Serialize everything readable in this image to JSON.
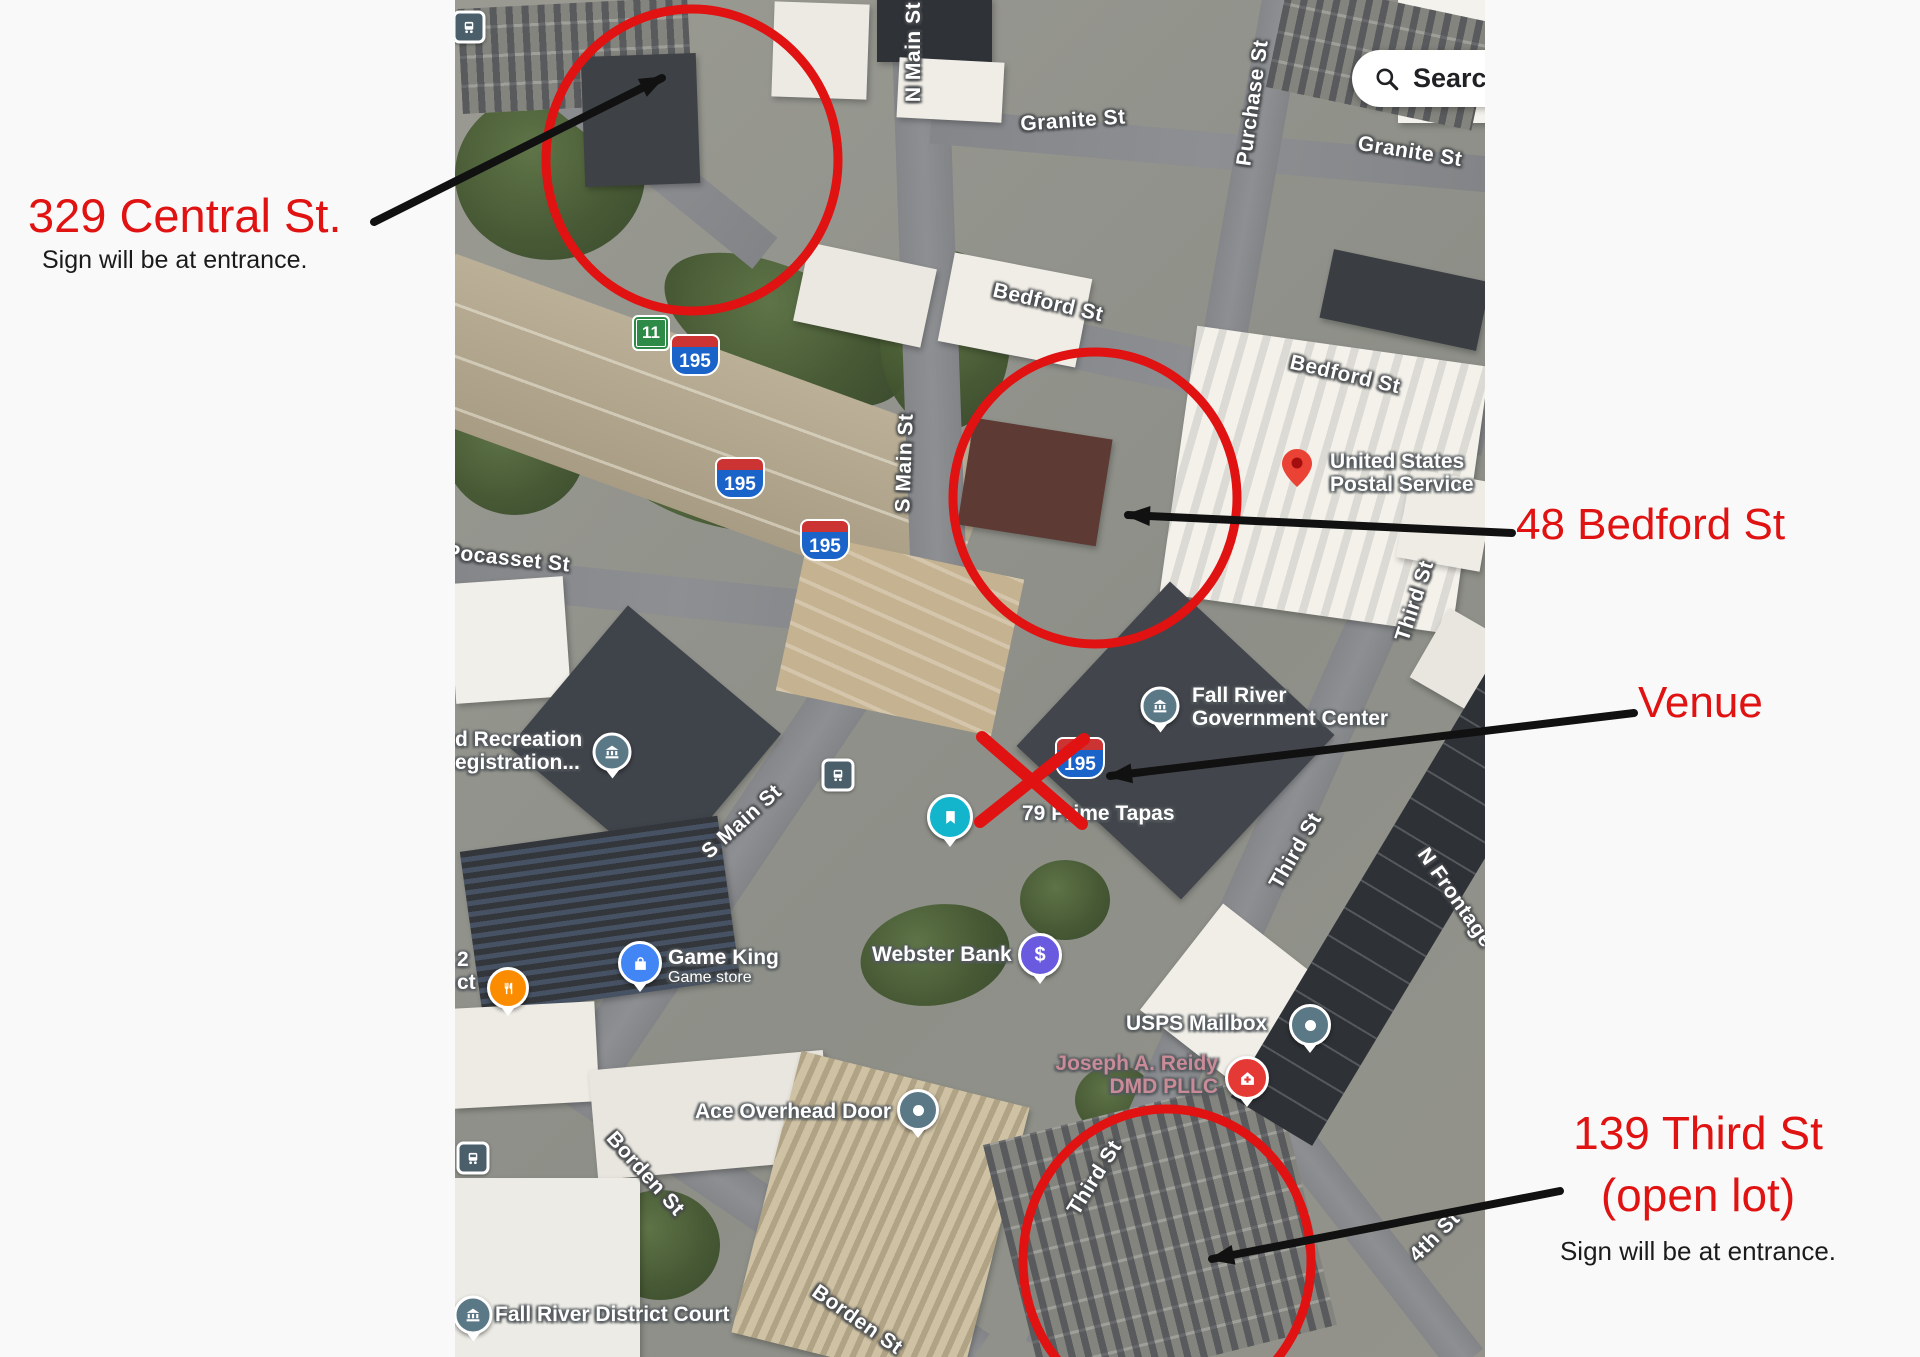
{
  "annotations": {
    "central_title": "329 Central St.",
    "central_subtitle": "Sign will be at entrance.",
    "bedford_title": "48 Bedford St",
    "venue_title": "Venue",
    "third_title": "139 Third St",
    "third_title2": "(open lot)",
    "third_subtitle": "Sign will be at entrance.",
    "colors": {
      "annotation_red": "#e01212",
      "arrow_black": "#111111"
    }
  },
  "search": {
    "text": "Search",
    "icon": "magnifier-icon"
  },
  "streets": [
    {
      "text": "N Main St"
    },
    {
      "text": "Granite St"
    },
    {
      "text": "Purchase St"
    },
    {
      "text": "Granite St"
    },
    {
      "text": "Bedford St"
    },
    {
      "text": "Bedford St"
    },
    {
      "text": "S Main St"
    },
    {
      "text": "S Main St"
    },
    {
      "text": "Pocasset St"
    },
    {
      "text": "Third St"
    },
    {
      "text": "Third St"
    },
    {
      "text": "Third St"
    },
    {
      "text": "Borden St"
    },
    {
      "text": "Borden St"
    },
    {
      "text": "4th St"
    },
    {
      "text": "N Frontage"
    }
  ],
  "shields": {
    "interstate": "195",
    "state": "11"
  },
  "pois": {
    "usps_line1": "United States",
    "usps_line2": "Postal Service",
    "gov_line1": "Fall River",
    "gov_line2": "Government Center",
    "prime_tapas": "79 Prime Tapas",
    "recreation_line1": "d Recreation",
    "recreation_line2": "egistration...",
    "game_king": "Game King",
    "game_king_sub": "Game store",
    "webster": "Webster Bank",
    "webster_glyph": "$",
    "usps_mailbox": "USPS Mailbox",
    "reidy_line1": "Joseph A. Reidy",
    "reidy_line2": "DMD PLLC",
    "ace": "Ace Overhead Door",
    "court": "Fall River District Court",
    "cut_label_1": "2",
    "cut_label_2": "ct"
  }
}
